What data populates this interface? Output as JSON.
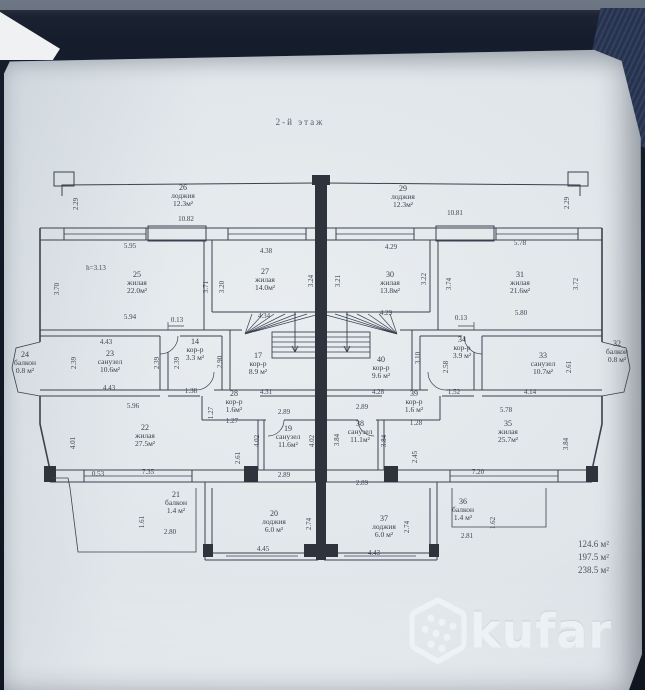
{
  "plan": {
    "title": "2-й этаж",
    "rooms": [
      {
        "n": "26",
        "t": "лоджия",
        "a": "12.3м²",
        "x": 183,
        "y": 196
      },
      {
        "n": "29",
        "t": "лоджия",
        "a": "12.3м²",
        "x": 403,
        "y": 197
      },
      {
        "n": "25",
        "t": "жилая",
        "a": "22.0м²",
        "x": 137,
        "y": 283
      },
      {
        "n": "27",
        "t": "жилая",
        "a": "14.0м²",
        "x": 265,
        "y": 280
      },
      {
        "n": "30",
        "t": "жилая",
        "a": "13.8м²",
        "x": 390,
        "y": 283
      },
      {
        "n": "31",
        "t": "жилая",
        "a": "21.6м²",
        "x": 520,
        "y": 283
      },
      {
        "n": "24",
        "t": "балкон",
        "a": "0.8 м²",
        "x": 25,
        "y": 363,
        "s": 6.5
      },
      {
        "n": "23",
        "t": "санузел",
        "a": "10.6м²",
        "x": 110,
        "y": 362
      },
      {
        "n": "14",
        "t": "кор-р",
        "a": "3.3 м²",
        "x": 195,
        "y": 350
      },
      {
        "n": "17",
        "t": "кор-р",
        "a": "8.9 м²",
        "x": 258,
        "y": 364
      },
      {
        "n": "40",
        "t": "кор-р",
        "a": "9.6 м²",
        "x": 381,
        "y": 368
      },
      {
        "n": "34",
        "t": "кор-р",
        "a": "3.9 м²",
        "x": 462,
        "y": 348
      },
      {
        "n": "33",
        "t": "санузел",
        "a": "10.7м²",
        "x": 543,
        "y": 364
      },
      {
        "n": "32",
        "t": "балкон",
        "a": "0.8 м²",
        "x": 617,
        "y": 352,
        "s": 6.5
      },
      {
        "n": "22",
        "t": "жилая",
        "a": "27.5м²",
        "x": 145,
        "y": 436
      },
      {
        "n": "28",
        "t": "кор-р",
        "a": "1.6м²",
        "x": 234,
        "y": 402,
        "s": 6.5
      },
      {
        "n": "19",
        "t": "санузел",
        "a": "11.6м²",
        "x": 288,
        "y": 437
      },
      {
        "n": "38",
        "t": "санузел",
        "a": "11.1м²",
        "x": 360,
        "y": 432
      },
      {
        "n": "39",
        "t": "кор-р",
        "a": "1.6 м²",
        "x": 414,
        "y": 402,
        "s": 6.5
      },
      {
        "n": "35",
        "t": "жилая",
        "a": "25.7м²",
        "x": 508,
        "y": 432
      },
      {
        "n": "21",
        "t": "балкон",
        "a": "1.4 м²",
        "x": 176,
        "y": 503
      },
      {
        "n": "20",
        "t": "лоджия",
        "a": "6.0 м²",
        "x": 274,
        "y": 522
      },
      {
        "n": "37",
        "t": "лоджия",
        "a": "6.0 м²",
        "x": 384,
        "y": 527
      },
      {
        "n": "36",
        "t": "балкон",
        "a": "1.4 м²",
        "x": 463,
        "y": 510
      }
    ],
    "dimensions": [
      {
        "t": "2.29",
        "x": 76,
        "y": 204,
        "r": 1
      },
      {
        "t": "10.82",
        "x": 186,
        "y": 219
      },
      {
        "t": "10.81",
        "x": 455,
        "y": 213
      },
      {
        "t": "2.29",
        "x": 567,
        "y": 203,
        "r": 1
      },
      {
        "t": "5.95",
        "x": 130,
        "y": 246
      },
      {
        "t": "4.38",
        "x": 266,
        "y": 251
      },
      {
        "t": "4.29",
        "x": 391,
        "y": 247
      },
      {
        "t": "5.78",
        "x": 520,
        "y": 243
      },
      {
        "t": "h=3.13",
        "x": 96,
        "y": 268
      },
      {
        "t": "3.70",
        "x": 57,
        "y": 289,
        "r": 1
      },
      {
        "t": "3.71",
        "x": 206,
        "y": 287,
        "r": 1
      },
      {
        "t": "3.20",
        "x": 222,
        "y": 287,
        "r": 1
      },
      {
        "t": "3.24",
        "x": 311,
        "y": 281,
        "r": 1
      },
      {
        "t": "3.21",
        "x": 338,
        "y": 281,
        "r": 1
      },
      {
        "t": "3.22",
        "x": 424,
        "y": 279,
        "r": 1
      },
      {
        "t": "3.74",
        "x": 449,
        "y": 284,
        "r": 1
      },
      {
        "t": "3.72",
        "x": 576,
        "y": 284,
        "r": 1
      },
      {
        "t": "5.94",
        "x": 130,
        "y": 317
      },
      {
        "t": "0.13",
        "x": 177,
        "y": 320
      },
      {
        "t": "4.34",
        "x": 264,
        "y": 316
      },
      {
        "t": "4.29",
        "x": 386,
        "y": 313
      },
      {
        "t": "0.13",
        "x": 461,
        "y": 318
      },
      {
        "t": "5.80",
        "x": 521,
        "y": 313
      },
      {
        "t": "4.43",
        "x": 106,
        "y": 342
      },
      {
        "t": "2.39",
        "x": 74,
        "y": 363,
        "r": 1
      },
      {
        "t": "2.39",
        "x": 157,
        "y": 363,
        "r": 1
      },
      {
        "t": "2.39",
        "x": 177,
        "y": 363,
        "r": 1
      },
      {
        "t": "2.90",
        "x": 220,
        "y": 362,
        "r": 1
      },
      {
        "t": "4.43",
        "x": 109,
        "y": 388
      },
      {
        "t": "1.38",
        "x": 191,
        "y": 391
      },
      {
        "t": "4.31",
        "x": 266,
        "y": 392
      },
      {
        "t": "4.28",
        "x": 378,
        "y": 392
      },
      {
        "t": "3.10",
        "x": 418,
        "y": 358,
        "r": 1
      },
      {
        "t": "2.58",
        "x": 446,
        "y": 367,
        "r": 1
      },
      {
        "t": "2.61",
        "x": 569,
        "y": 367,
        "r": 1
      },
      {
        "t": "1.52",
        "x": 454,
        "y": 392
      },
      {
        "t": "4.14",
        "x": 530,
        "y": 392
      },
      {
        "t": "5.96",
        "x": 133,
        "y": 406
      },
      {
        "t": "5.78",
        "x": 506,
        "y": 410
      },
      {
        "t": "4.01",
        "x": 73,
        "y": 443,
        "r": 1
      },
      {
        "t": "0.53",
        "x": 98,
        "y": 474
      },
      {
        "t": "7.35",
        "x": 148,
        "y": 472
      },
      {
        "t": "1.27",
        "x": 211,
        "y": 413,
        "r": 1
      },
      {
        "t": "1.27",
        "x": 232,
        "y": 421
      },
      {
        "t": "2.89",
        "x": 284,
        "y": 412
      },
      {
        "t": "2.89",
        "x": 362,
        "y": 407
      },
      {
        "t": "4.02",
        "x": 257,
        "y": 441,
        "r": 1
      },
      {
        "t": "4.02",
        "x": 312,
        "y": 441,
        "r": 1
      },
      {
        "t": "3.84",
        "x": 337,
        "y": 440,
        "r": 1
      },
      {
        "t": "3.84",
        "x": 384,
        "y": 441,
        "r": 1
      },
      {
        "t": "2.61",
        "x": 238,
        "y": 458,
        "r": 1
      },
      {
        "t": "2.45",
        "x": 415,
        "y": 457,
        "r": 1
      },
      {
        "t": "3.84",
        "x": 566,
        "y": 444,
        "r": 1
      },
      {
        "t": "2.89",
        "x": 284,
        "y": 475
      },
      {
        "t": "2.89",
        "x": 362,
        "y": 483
      },
      {
        "t": "1.28",
        "x": 416,
        "y": 423
      },
      {
        "t": "7.20",
        "x": 478,
        "y": 472
      },
      {
        "t": "1.61",
        "x": 142,
        "y": 522,
        "r": 1
      },
      {
        "t": "2.80",
        "x": 170,
        "y": 532
      },
      {
        "t": "2.74",
        "x": 309,
        "y": 524,
        "r": 1
      },
      {
        "t": "4.45",
        "x": 263,
        "y": 549
      },
      {
        "t": "2.74",
        "x": 407,
        "y": 527,
        "r": 1
      },
      {
        "t": "4.43",
        "x": 374,
        "y": 553
      },
      {
        "t": "1.62",
        "x": 493,
        "y": 523,
        "r": 1
      },
      {
        "t": "2.81",
        "x": 467,
        "y": 536
      }
    ]
  },
  "totals": [
    "124.6 м²",
    "197.5 м²",
    "238.5 м²"
  ],
  "watermark": {
    "brand": "kufar",
    "icon": "kufar-hexagon-dots-icon"
  },
  "colors": {
    "paper": "#dfe5e9",
    "ink": "#3a424f",
    "background": "#10161f",
    "denim": "#2c3a5e",
    "watermark": "#ffffff"
  }
}
